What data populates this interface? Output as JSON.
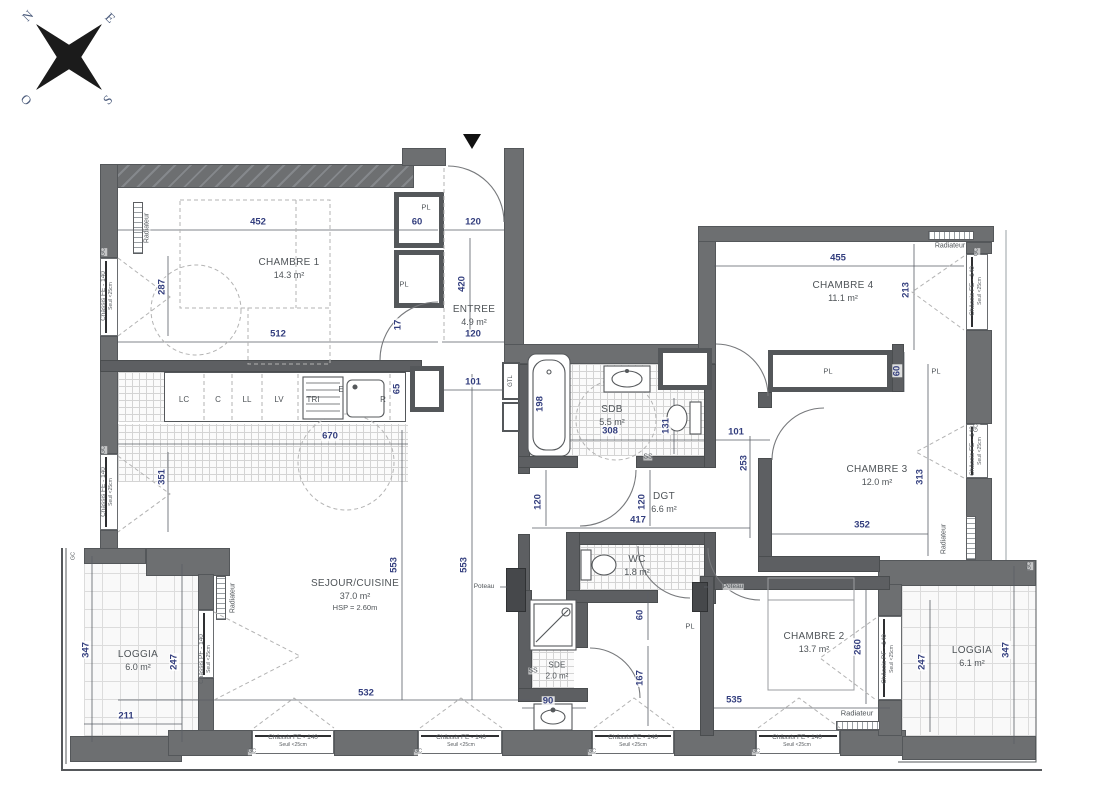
{
  "compass": {
    "n": "N",
    "e": "E",
    "s": "S",
    "o": "O"
  },
  "rooms": {
    "chambre1": {
      "name": "CHAMBRE 1",
      "area": "14.3 m²"
    },
    "entree": {
      "name": "ENTREE",
      "area": "4.9 m²"
    },
    "chambre4": {
      "name": "CHAMBRE 4",
      "area": "11.1 m²"
    },
    "sdb": {
      "name": "SDB",
      "area": "5.5 m²"
    },
    "dgt": {
      "name": "DGT",
      "area": "6.6 m²"
    },
    "chambre3": {
      "name": "CHAMBRE 3",
      "area": "12.0 m²"
    },
    "wc": {
      "name": "WC",
      "area": "1.8 m²"
    },
    "sde": {
      "name": "SDE",
      "area": "2.0 m²"
    },
    "sejour": {
      "name": "SEJOUR/CUISINE",
      "area": "37.0 m²",
      "hsp": "HSP = 2.60m"
    },
    "chambre2": {
      "name": "CHAMBRE 2",
      "area": "13.7 m²"
    },
    "loggia_left": {
      "name": "LOGGIA",
      "area": "6.0 m²"
    },
    "loggia_right": {
      "name": "LOGGIA",
      "area": "6.1 m²"
    }
  },
  "kitchen_units": [
    "LC",
    "C",
    "LL",
    "LV",
    "TRI",
    "E",
    "R"
  ],
  "labels": {
    "radiateur": "Radiateur",
    "poteau": "Poteau",
    "gtl": "GTL",
    "ss": "SS",
    "pl": "PL",
    "gc": "GC"
  },
  "windows": {
    "fe": "Châssis FE - 140",
    "pf": "Châssis PF - 140",
    "seuil": "Seuil <25cm"
  },
  "dims": {
    "ch1_top": "452",
    "ch1_bottom": "512",
    "ch1_window": "287",
    "ch1_door": "17",
    "entree_pl": "60",
    "entree_top": "120",
    "entree_height": "420",
    "entree_bottom": "120",
    "entree_kitchen": "101",
    "kitchen_length": "670",
    "kitchen_depth": "65",
    "sejour_window": "351",
    "sejour_height_a": "553",
    "sejour_height_b": "553",
    "sejour_width": "532",
    "loggia_left_width": "211",
    "loggia_left_height": "347",
    "loggia_left_depth": "247",
    "sdb_height": "198",
    "sdb_width": "308",
    "sdb_wc": "131",
    "dgt_top": "101",
    "dgt_height": "253",
    "dgt_width": "417",
    "dgt_door_a": "120",
    "dgt_door_b": "120",
    "wc_pl": "60",
    "wc_height": "167",
    "sde_width": "90",
    "ch2_width": "535",
    "ch2_height": "260",
    "loggia_right_depth": "247",
    "loggia_right_height": "347",
    "ch3_width": "352",
    "ch3_height": "313",
    "pl_ch3": "60",
    "ch4_width": "455",
    "ch4_height": "213"
  },
  "colors": {
    "wall": "#6d6f71",
    "dim_text": "#333e7e",
    "label_text": "#4f5458"
  }
}
